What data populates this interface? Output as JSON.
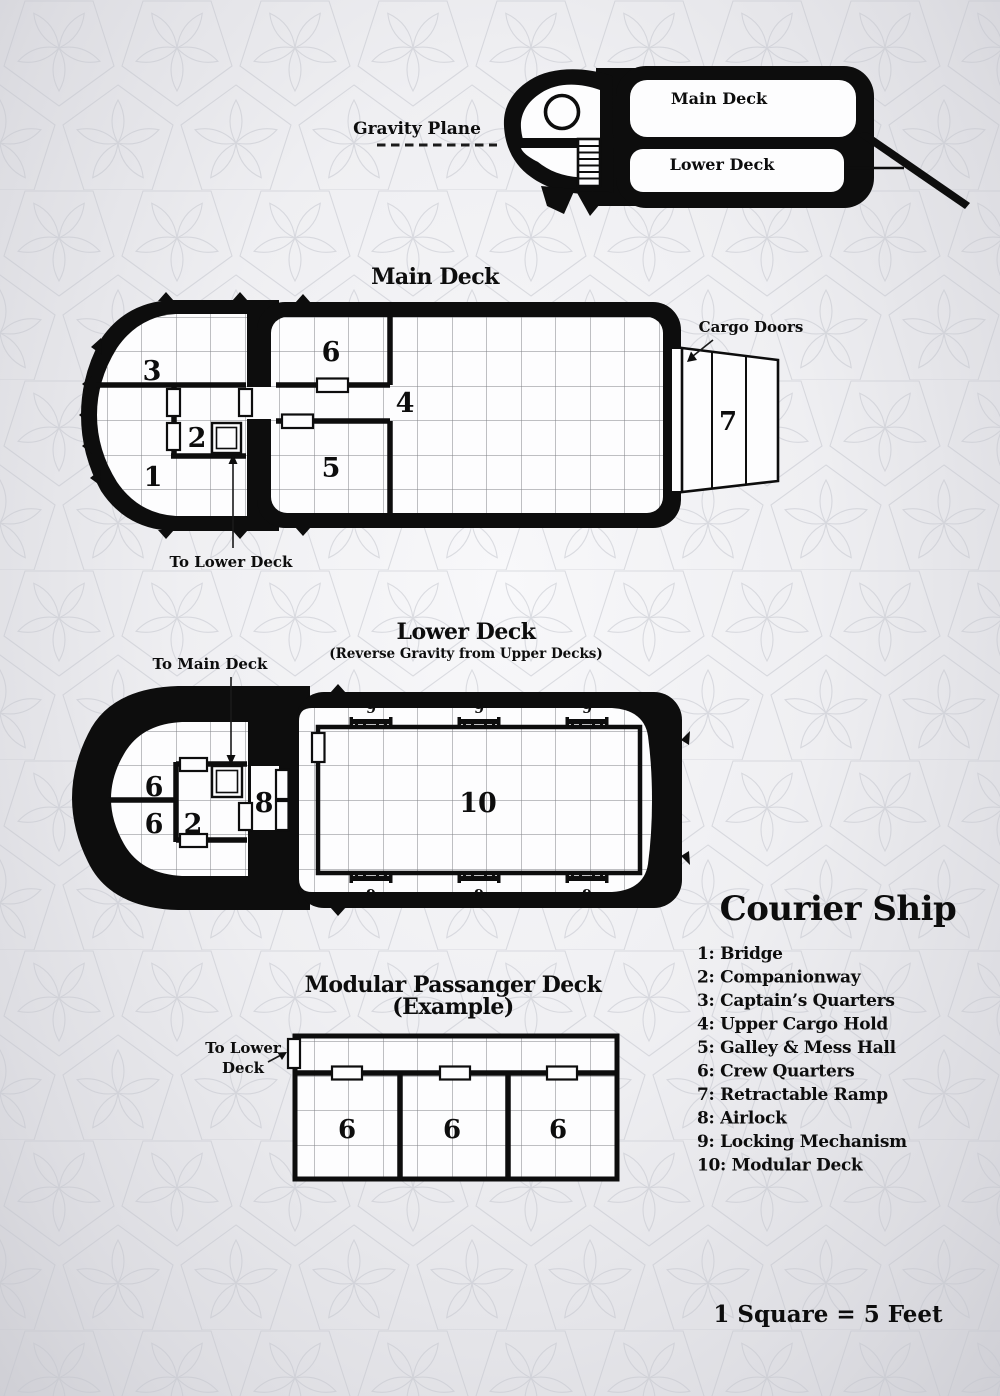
{
  "side_view": {
    "gravity_plane_label": "Gravity Plane",
    "main_deck_label": "Main Deck",
    "lower_deck_label": "Lower Deck"
  },
  "main_deck": {
    "title": "Main Deck",
    "cargo_doors_label": "Cargo Doors",
    "to_lower_deck_label": "To Lower Deck",
    "room_numbers": {
      "bridge": "1",
      "companionway": "2",
      "captains_quarters": "3",
      "upper_cargo_hold": "4",
      "galley_mess_hall": "5",
      "crew_quarters": "6",
      "retractable_ramp": "7"
    }
  },
  "lower_deck": {
    "title": "Lower Deck",
    "subtitle": "(Reverse Gravity from Upper Decks)",
    "to_main_deck_label": "To Main Deck",
    "room_numbers": {
      "crew_quarters": "6",
      "companionway": "2",
      "airlock": "8",
      "locking_mechanism": "9",
      "modular_deck": "10"
    }
  },
  "modular_deck": {
    "title": "Modular Passanger Deck",
    "subtitle": "(Example)",
    "to_lower_deck_line1": "To Lower",
    "to_lower_deck_line2": "Deck",
    "room_numbers": {
      "crew_quarters": "6"
    }
  },
  "legend": {
    "title": "Courier Ship",
    "items": [
      "1: Bridge",
      "2: Companionway",
      "3: Captain’s Quarters",
      "4: Upper Cargo Hold",
      "5: Galley & Mess Hall",
      "6: Crew Quarters",
      "7: Retractable Ramp",
      "8: Airlock",
      "9: Locking Mechanism",
      "10: Modular Deck"
    ]
  },
  "scale_note": "1 Square = 5 Feet",
  "colors": {
    "ink": "#0d0d0d",
    "paper": "#fdfdfe",
    "grid": "#606168"
  }
}
